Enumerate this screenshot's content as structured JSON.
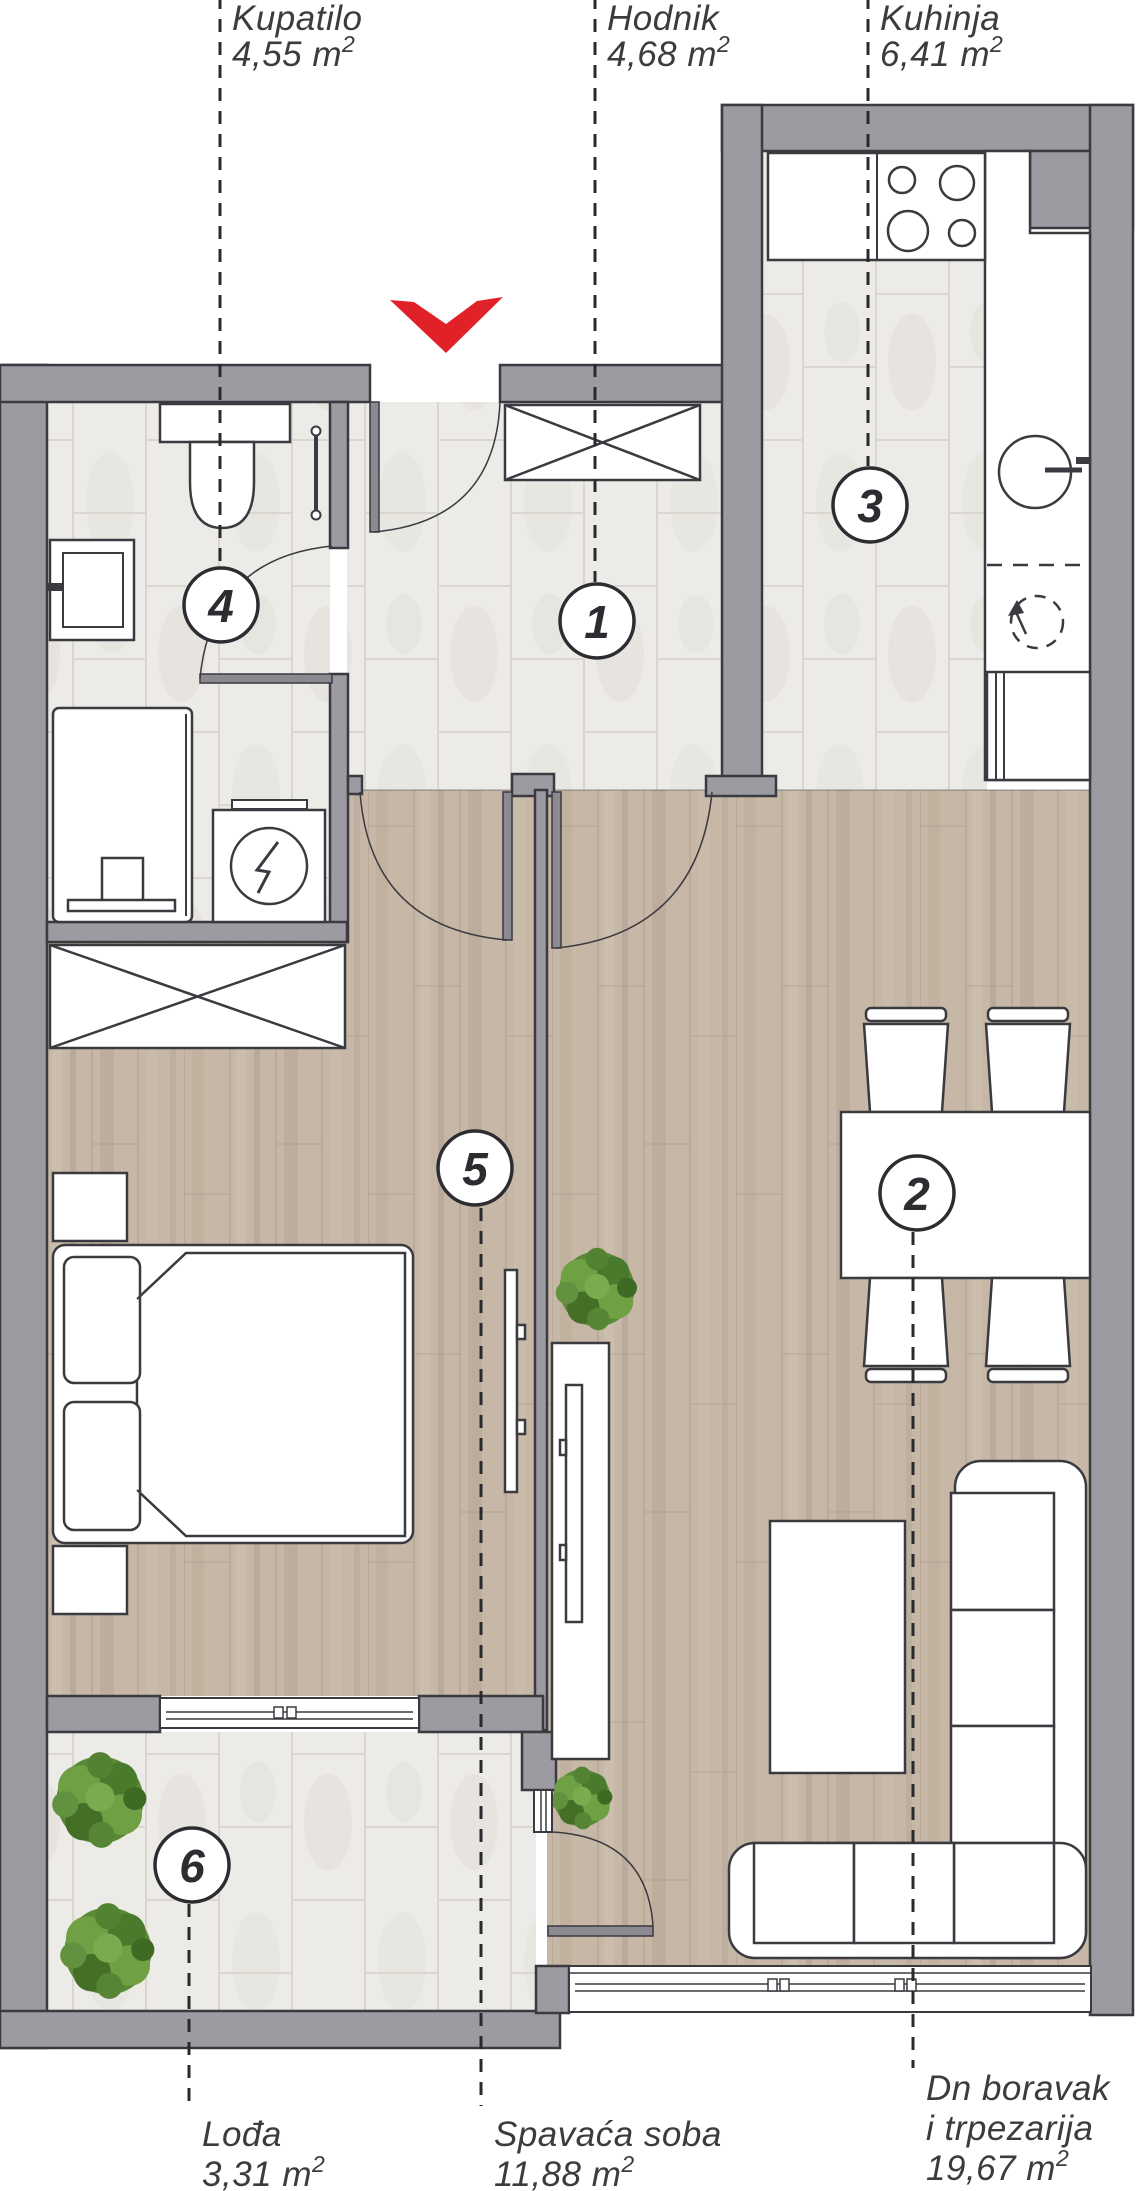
{
  "palette": {
    "wall_fill": "#9b9ba1",
    "outline": "#3a3a40",
    "accent_red": "#e02228",
    "tile_floor": "#edebe7",
    "wood_floor": "#c6b7a6",
    "leader_line": "#2a2a2e",
    "label_text": "#3b3b40"
  },
  "rooms": [
    {
      "number": "1",
      "name": "Hodnik",
      "area_value": "4,68 m",
      "area_sup": "2"
    },
    {
      "number": "2",
      "name_line1": "Dn boravak",
      "name_line2": "i trpezarija",
      "area_value": "19,67 m",
      "area_sup": "2"
    },
    {
      "number": "3",
      "name": "Kuhinja",
      "area_value": "6,41 m",
      "area_sup": "2"
    },
    {
      "number": "4",
      "name": "Kupatilo",
      "area_value": "4,55 m",
      "area_sup": "2"
    },
    {
      "number": "5",
      "name": "Spavaća soba",
      "area_value": "11,88 m",
      "area_sup": "2"
    },
    {
      "number": "6",
      "name": "Lođa",
      "area_value": "3,31 m",
      "area_sup": "2"
    }
  ]
}
